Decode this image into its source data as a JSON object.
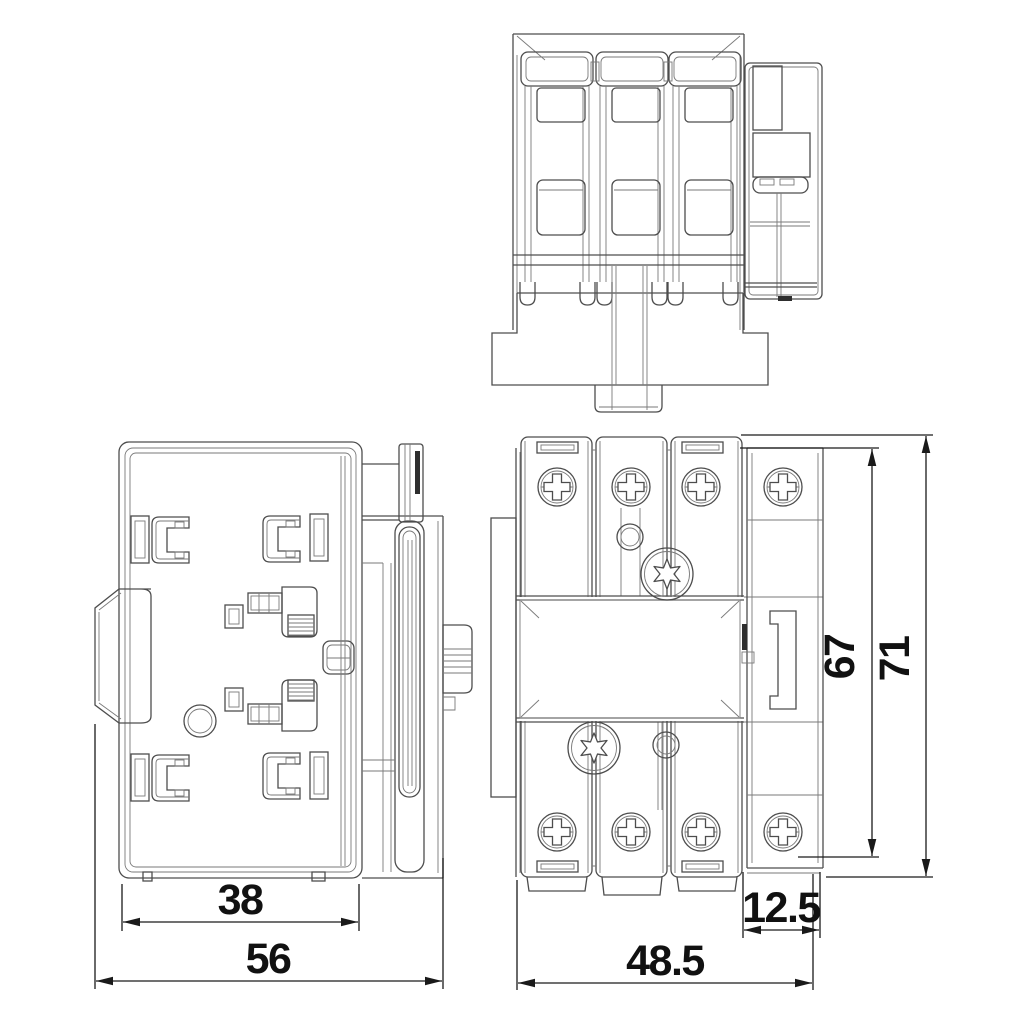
{
  "colors": {
    "background": "#ffffff",
    "line": "#4d4d4d",
    "line_light": "#7a7a7a",
    "dimension": "#1a1a1a",
    "text": "#111111",
    "dark_fill": "#2e2e2e"
  },
  "views": {
    "side_view": {
      "id": "side-view"
    },
    "back_view": {
      "id": "back-view"
    },
    "front_view": {
      "id": "front-view"
    }
  },
  "dimensions": {
    "back_width_inner": {
      "label": "38"
    },
    "back_width_total": {
      "label": "56"
    },
    "front_width_body": {
      "label": "48.5"
    },
    "front_width_din": {
      "label": "12.5"
    },
    "front_height_inner": {
      "label": "67"
    },
    "front_height_total": {
      "label": "71"
    }
  }
}
